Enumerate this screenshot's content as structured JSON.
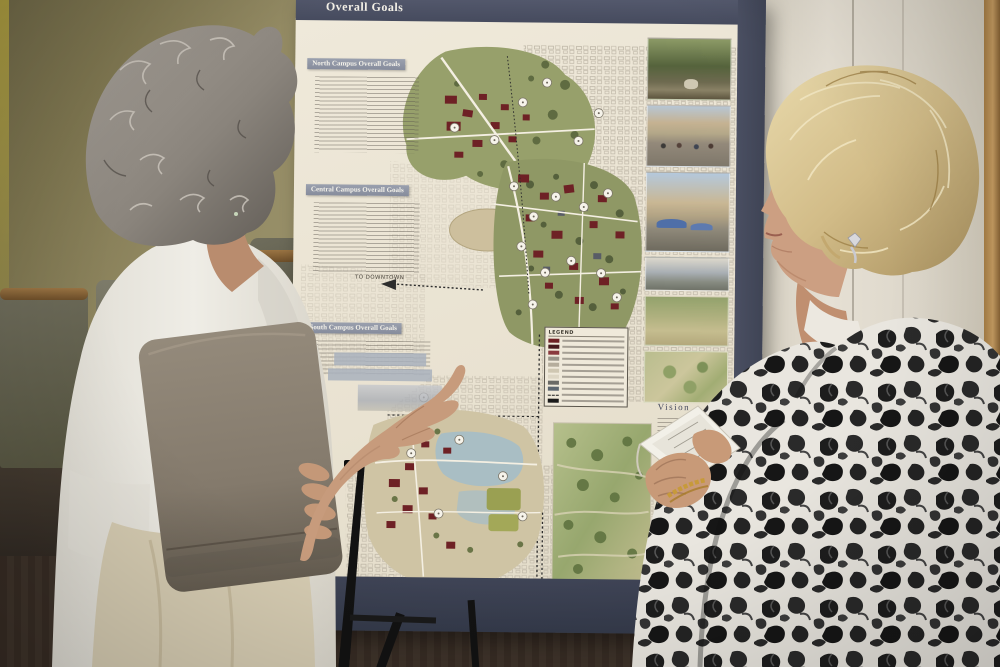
{
  "poster": {
    "title": "Overall Goals",
    "section_north": "North Campus Overall Goals",
    "section_central": "Central Campus Overall Goals",
    "section_south": "South Campus Overall Goals",
    "vision_title": "Vision",
    "legend_title": "LEGEND",
    "label_to_downtown": "TO DOWNTOWN",
    "label_to_airport": "TO AIRPORT",
    "credit_fragment": "ker Pr  habilid",
    "colors": {
      "board_band": "#464b5e",
      "paper_cream": "#ece5d4",
      "campus_building_red": "#6e2125",
      "campus_green": "#8f9865",
      "water_blue": "#a9bec4",
      "ground_tan": "#cfc4a4"
    },
    "legend_swatches": [
      "#6e2125",
      "#47191d",
      "#8a3a3e",
      "#9a958a",
      "#b5ad9c",
      "#cfc7b2",
      "#ddd6c4",
      "#6a6a66",
      "#5c6670",
      "dashed",
      "#1a1a1a"
    ]
  },
  "flipchart": {
    "fragments": [
      "NT",
      "E TO M",
      "LF COU",
      "E & UPD",
      "an expan"
    ]
  }
}
